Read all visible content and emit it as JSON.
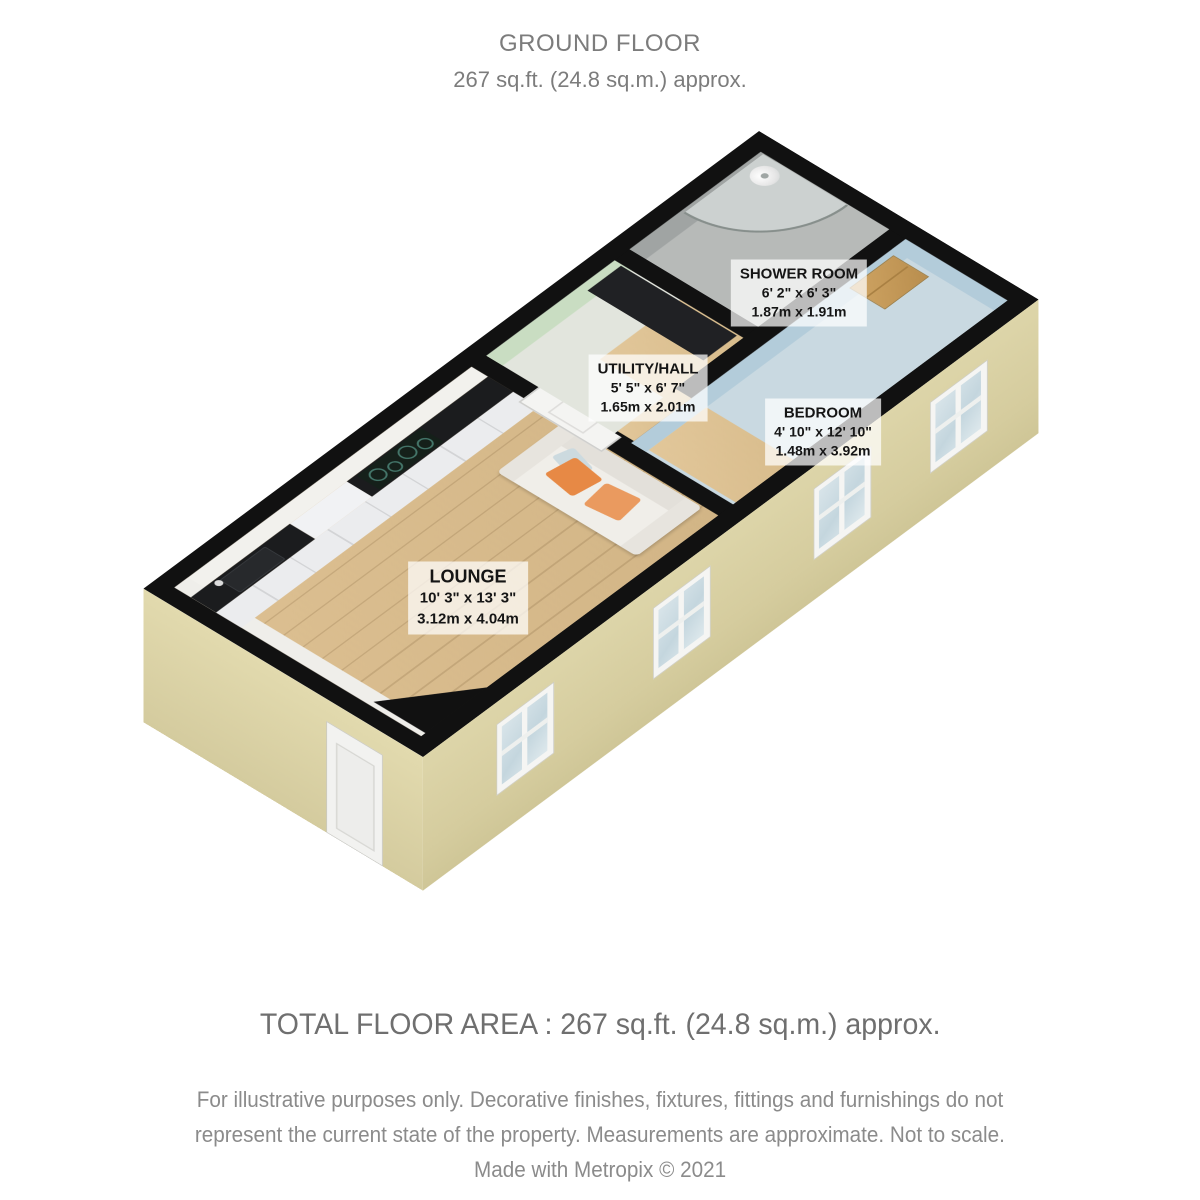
{
  "header": {
    "title": "GROUND FLOOR",
    "subtitle": "267 sq.ft. (24.8 sq.m.) approx."
  },
  "rooms": [
    {
      "name": "SHOWER ROOM",
      "imperial": "6' 2\" x 6' 3\"",
      "metric": "1.87m x 1.91m"
    },
    {
      "name": "UTILITY/HALL",
      "imperial": "5' 5\" x 6' 7\"",
      "metric": "1.65m x 2.01m"
    },
    {
      "name": "BEDROOM",
      "imperial": "4' 10\" x 12' 10\"",
      "metric": "1.48m x 3.92m"
    },
    {
      "name": "LOUNGE",
      "imperial": "10' 3\" x 13' 3\"",
      "metric": "3.12m x 4.04m"
    }
  ],
  "footer": {
    "total": "TOTAL FLOOR AREA : 267 sq.ft. (24.8 sq.m.) approx.",
    "disclaimer_line1": "For illustrative purposes only. Decorative finishes, fixtures, fittings and furnishings do not",
    "disclaimer_line2": "represent the current state of the property. Measurements are approximate. Not to scale.",
    "credit": "Made with Metropix © 2021"
  },
  "colors": {
    "wall": "#111111",
    "exterior_wall": "#d9d0a4",
    "lounge_floor_wood": "#d9bd8d",
    "utility_wall_green": "#c9ddc2",
    "bedroom_wall_blue": "#b3ccda",
    "shower_floor_gray": "#b7bab8",
    "cushion_accent_orange": "#e78945",
    "label_background": "rgba(255,255,255,0.72)",
    "heading_text_gray": "#7c7c7c"
  }
}
